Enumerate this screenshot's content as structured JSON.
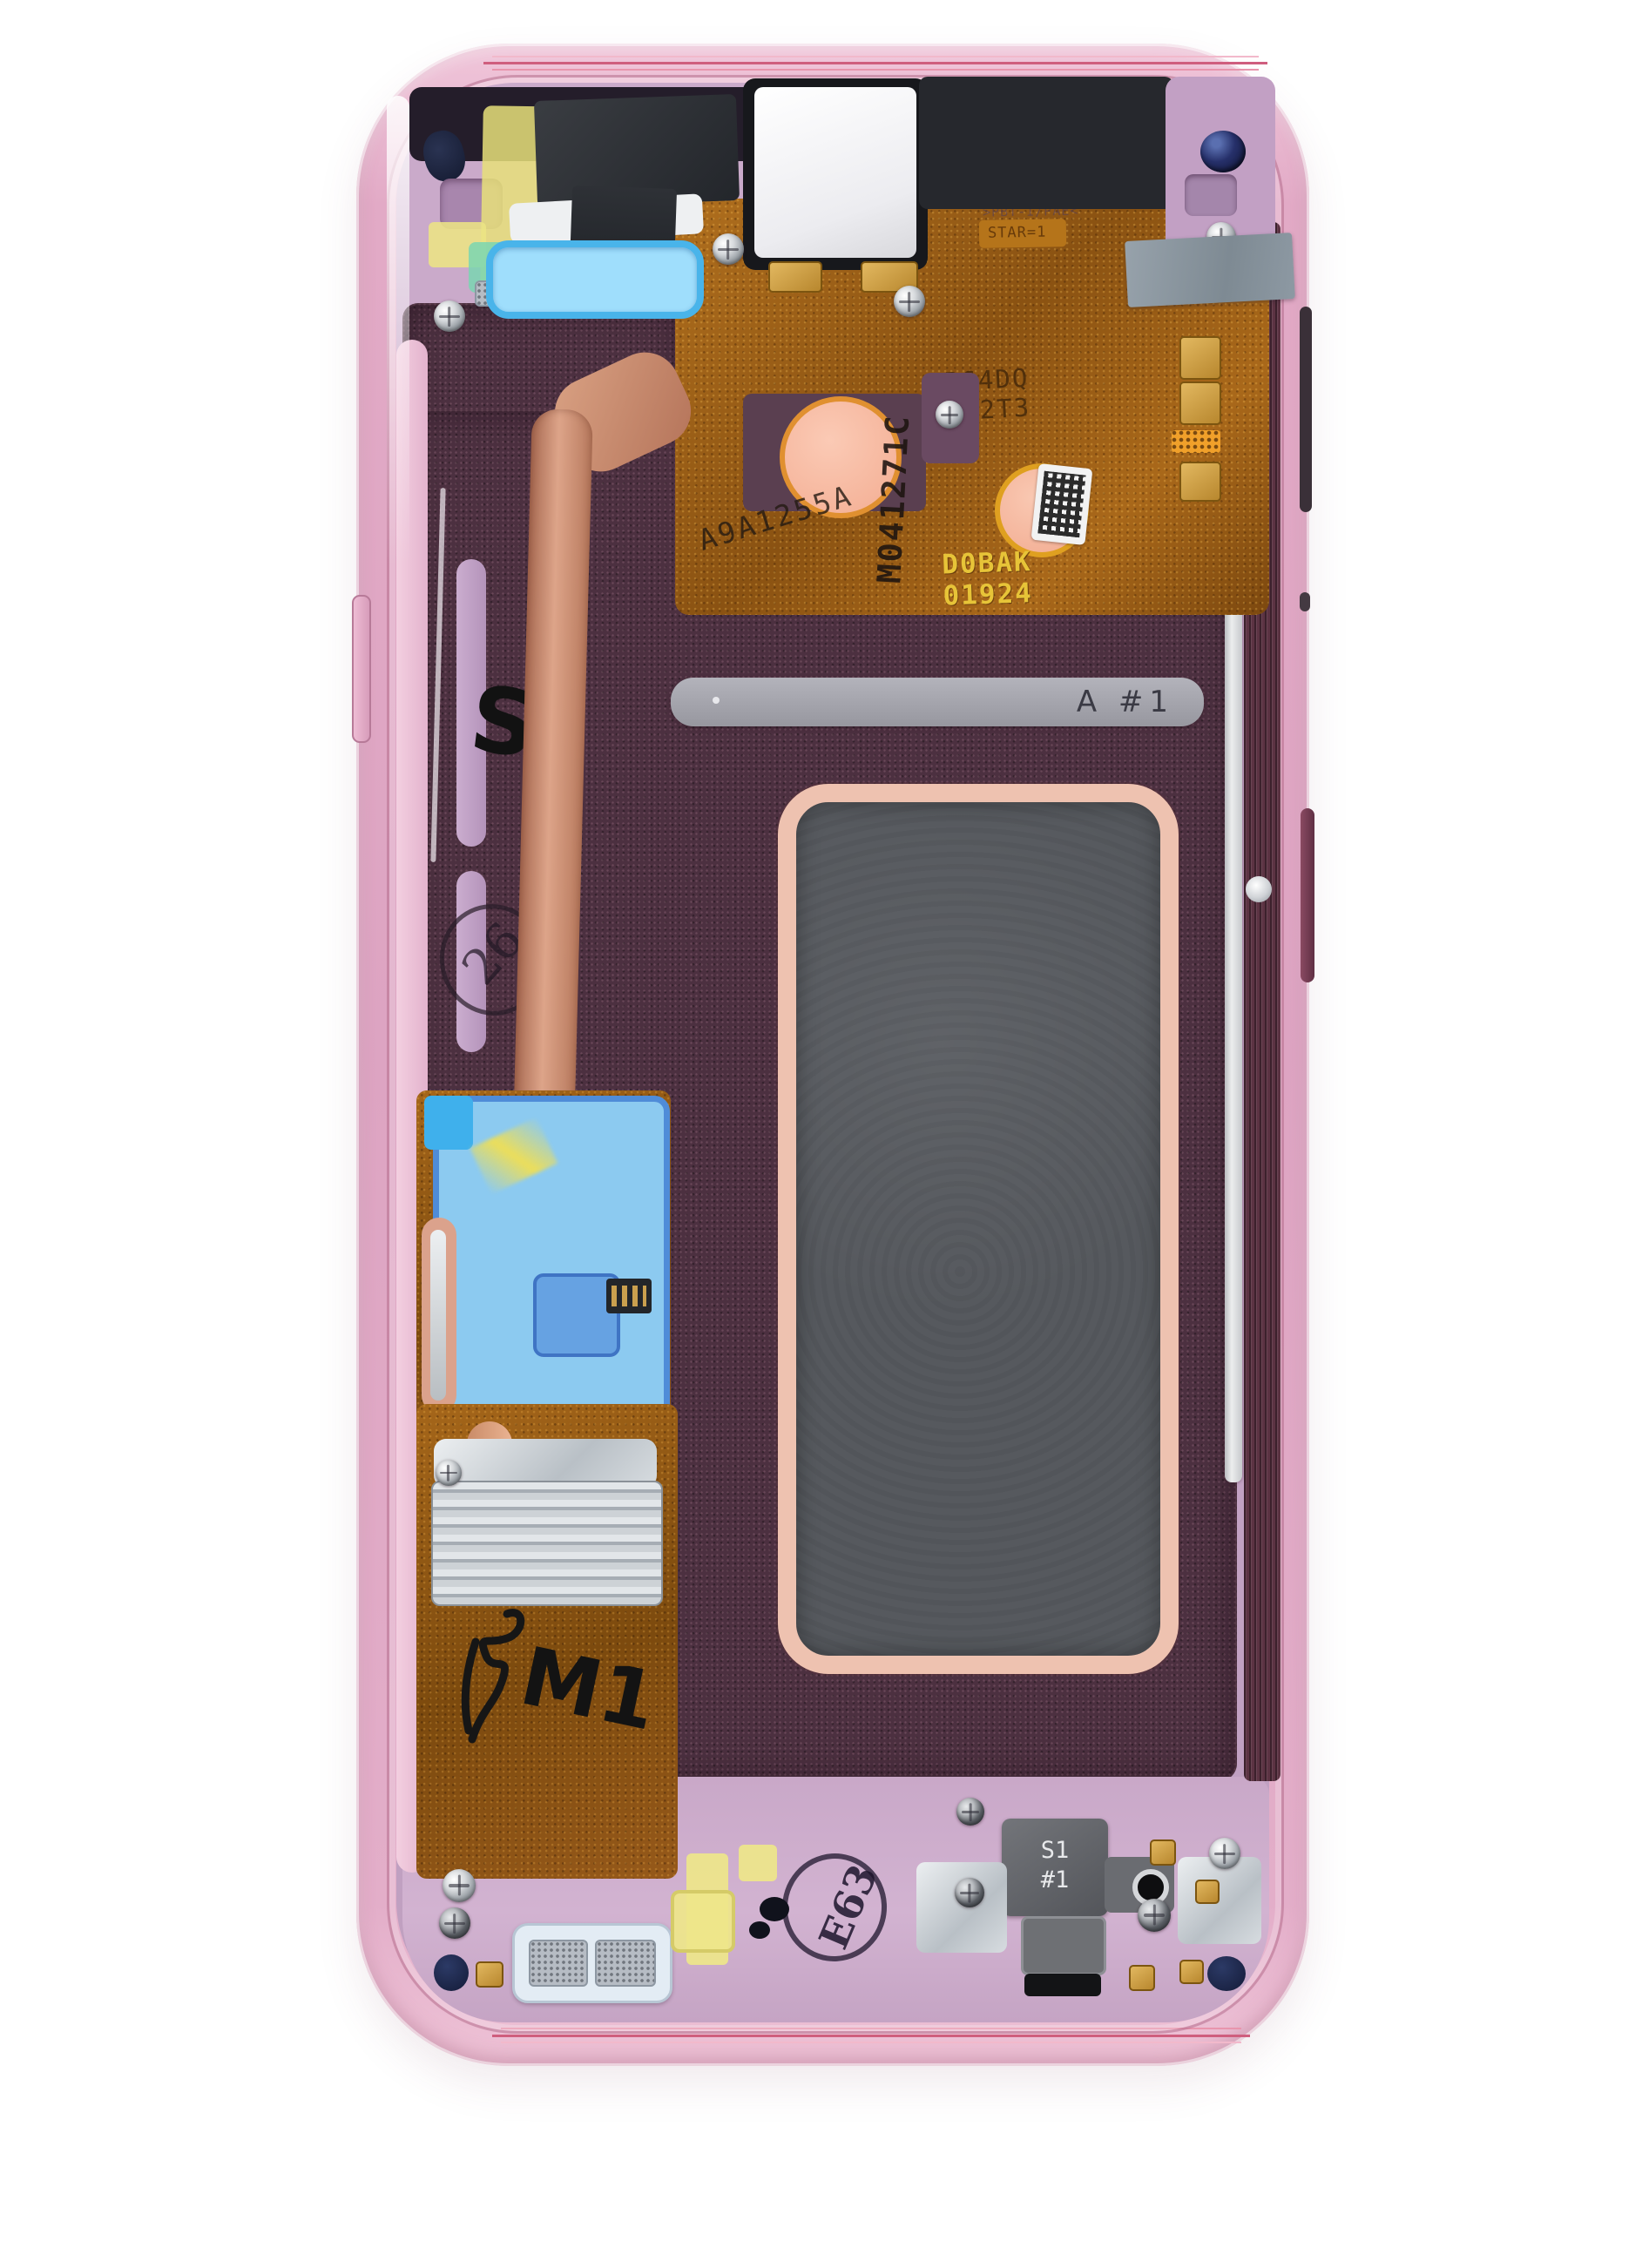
{
  "markings": {
    "bracket_bar": "A #1",
    "port_bracket_line1": "S1",
    "port_bracket_line2": "#1",
    "ink_stamp": "E63",
    "circle_stamp": "26",
    "handwritten_left": "S",
    "handwritten_bottom": "M1",
    "flex_serial_vertical": "M041271C",
    "flex_serial_diagonal": "A9A1255A",
    "flex_etch_line1": "B64DQ",
    "flex_etch_line2": "H22T3",
    "flex_print_line1": "D0BAK",
    "flex_print_line2": "01924",
    "molded_top": ">PBT-I/PAE<",
    "flex_top_small": "STAR=1"
  },
  "colors": {
    "background": "#ffffff",
    "frame_pink": "#e2aac6",
    "inner_lilac": "#c3a2c2",
    "plum_dark": "#4c3040",
    "copper_flex": "#9a5e16",
    "heat_pipe_copper": "#d9a183",
    "blue_tape": "#8ccaf0",
    "yellow_tape": "#ece47f",
    "teal_tape": "#7fd6b2",
    "gray_tape": "#8d99a3",
    "window_border_salmon": "#eec2b0",
    "window_gray": "#56595e",
    "bracket_gray": "#a5a5ad",
    "gold_pad": "#d4a94e"
  }
}
